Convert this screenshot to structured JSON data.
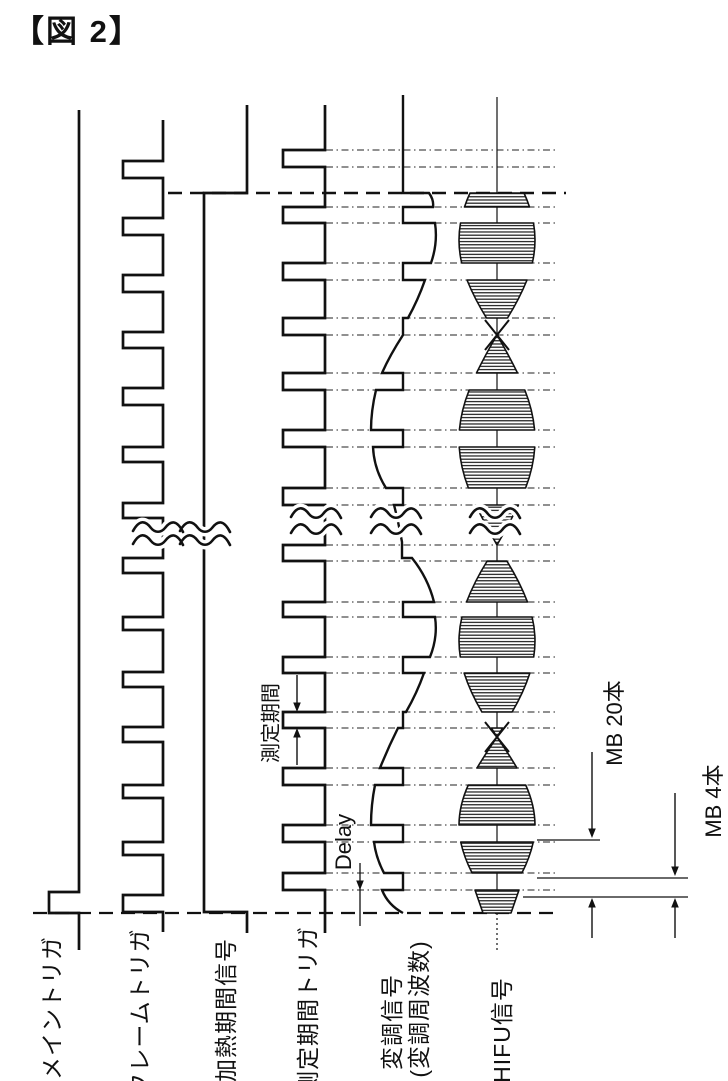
{
  "page": {
    "background": "#ffffff",
    "ink_color": "#111111"
  },
  "figure": {
    "title": "【図 2】"
  },
  "signal_labels": {
    "main_trigger": "メイントリガ",
    "frame_trigger": "フレームトリガ",
    "heating_period": "加熱期間信号",
    "measurement_trigger": "測定期間トリガ",
    "modulation_line1": "変調信号",
    "modulation_line2": "(変調周波数)",
    "hifu": "HIFU信号"
  },
  "annotations": {
    "measurement_period": "測定期間",
    "delay": "Delay",
    "mb_20": "MB 20本",
    "mb_4": "MB 4本"
  }
}
